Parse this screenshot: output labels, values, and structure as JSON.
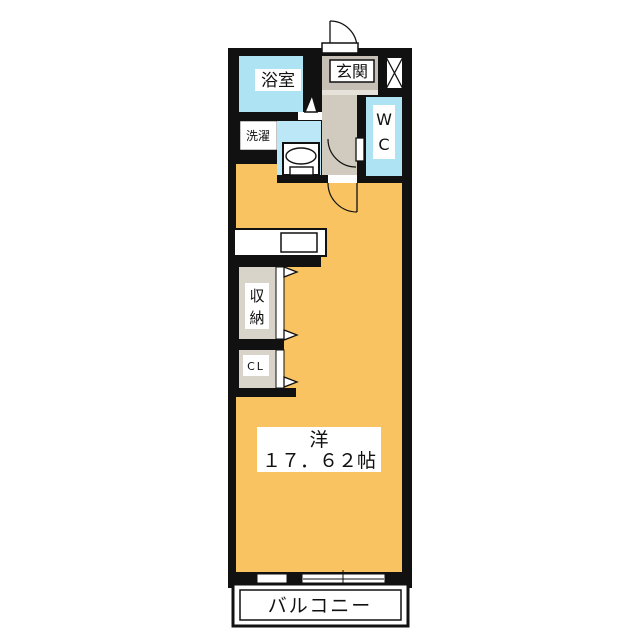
{
  "plan": {
    "type": "floor-plan",
    "rooms": {
      "bath": {
        "label": "浴室"
      },
      "entrance": {
        "label": "玄関"
      },
      "wc": {
        "chars": [
          "W",
          "C"
        ]
      },
      "laundry": {
        "label": "洗濯"
      },
      "storage": {
        "chars": [
          "収",
          "納"
        ]
      },
      "closet": {
        "label": "CL"
      },
      "main_room": {
        "name": "洋",
        "area": "１７．６２帖"
      },
      "balcony": {
        "label": "バルコニー"
      }
    },
    "colors": {
      "wall": "#111111",
      "room": "#F8C360",
      "water": "#AEE3F4",
      "washroom": "#BCE7F6",
      "hall": "#D0CABF",
      "genkan": "#C5BFB6",
      "step": "#E6E2DA",
      "closet_interior": "#D8D4CA",
      "white": "#FFFFFF"
    }
  }
}
